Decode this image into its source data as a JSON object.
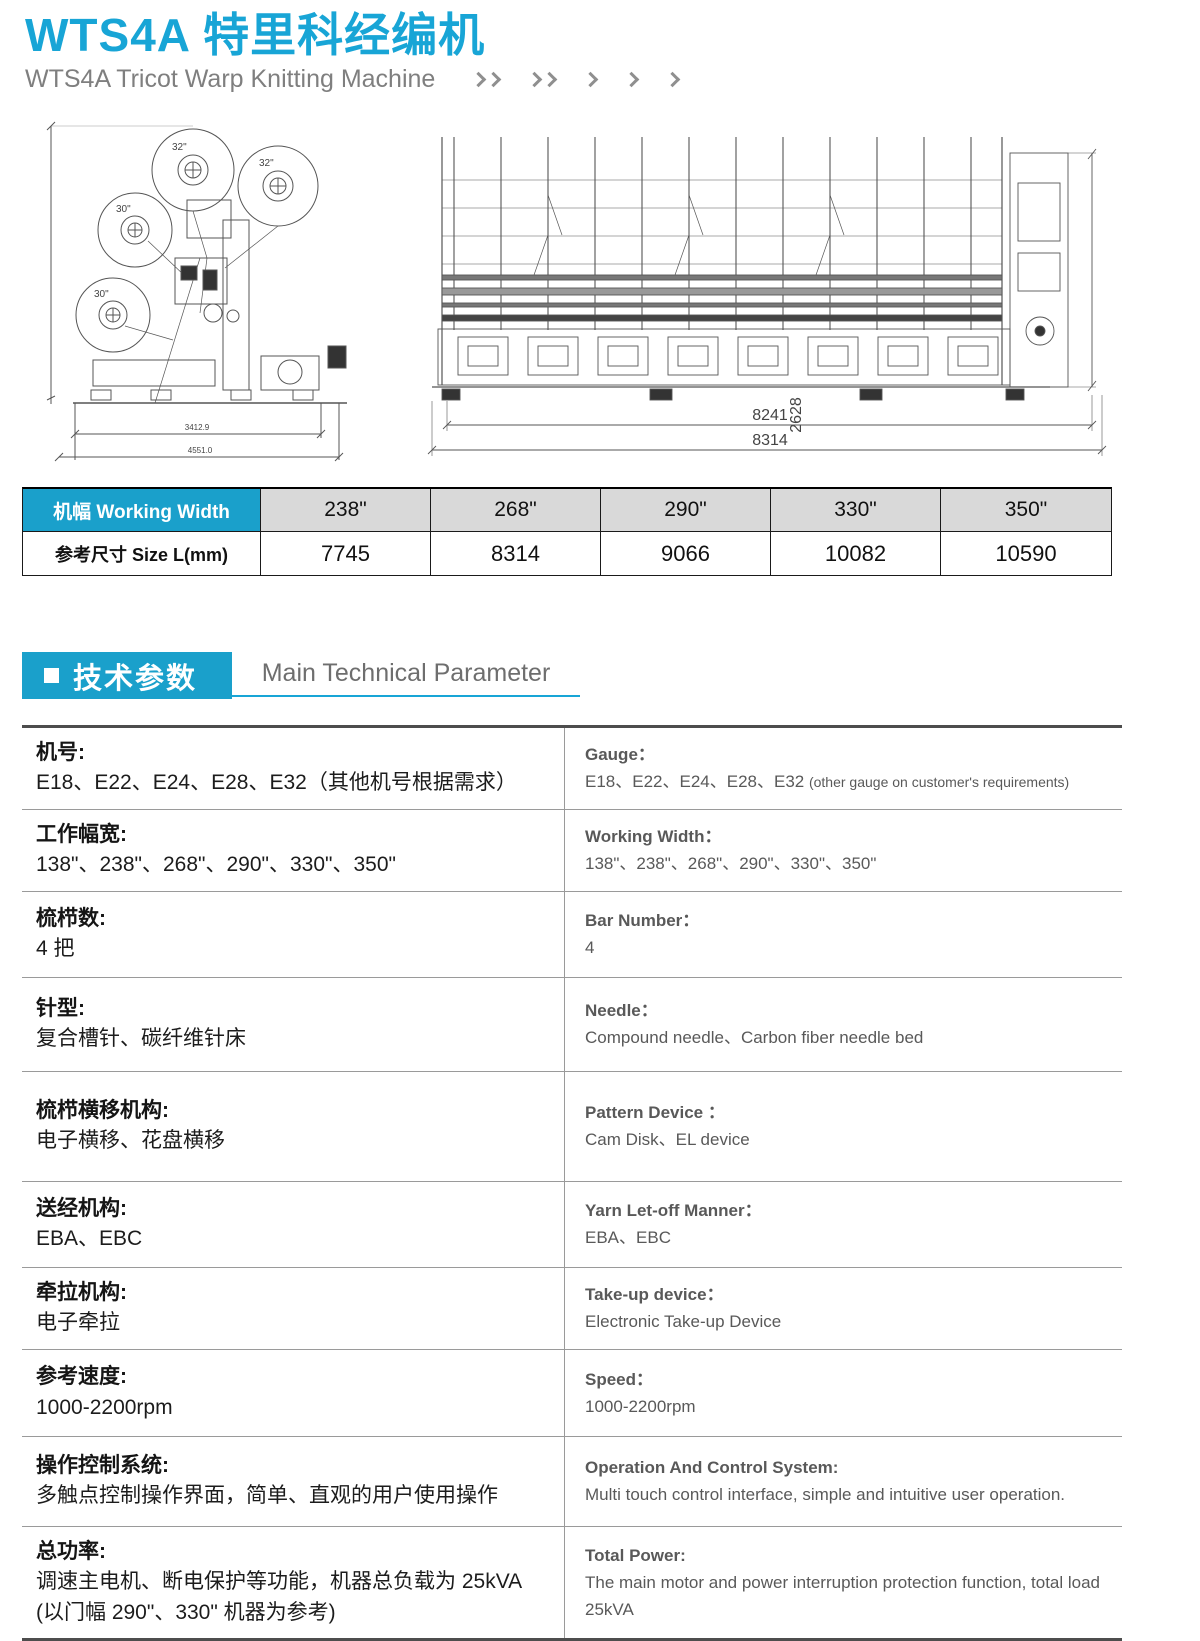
{
  "colors": {
    "accent": "#18a5d6",
    "accent-box": "#1aa0cb"
  },
  "header": {
    "title": "WTS4A 特里科经编机",
    "subtitle": "WTS4A Tricot Warp Knitting Machine"
  },
  "diagrams": {
    "side_view": {
      "beam_labels": [
        "32\"",
        "32\"",
        "30\"",
        "30\""
      ],
      "dim_height": "2568.8",
      "dim_width_inner": "3412.9",
      "dim_width_outer": "4551.0"
    },
    "front_view": {
      "dim_height": "2628",
      "dim_width_inner": "8241",
      "dim_width_outer": "8314"
    }
  },
  "size_table": {
    "header_label": "机幅 Working Width",
    "row_label": "参考尺寸 Size L(mm)",
    "widths": [
      "238\"",
      "268\"",
      "290\"",
      "330\"",
      "350\""
    ],
    "sizes": [
      "7745",
      "8314",
      "9066",
      "10082",
      "10590"
    ]
  },
  "section": {
    "title_cn": "技术参数",
    "title_en": "Main Technical Parameter"
  },
  "spec_rows": [
    {
      "cn_label": "机号:",
      "cn_value": "E18、E22、E24、E28、E32（其他机号根据需求）",
      "en_label": "Gauge：",
      "en_value": "E18、E22、E24、E28、E32 ",
      "en_note": "(other gauge on customer's requirements)"
    },
    {
      "cn_label": "工作幅宽:",
      "cn_value": "138\"、238\"、268\"、290\"、330\"、350\"",
      "en_label": "Working Width：",
      "en_value": "138\"、238\"、268\"、290\"、330\"、350\""
    },
    {
      "cn_label": "梳栉数:",
      "cn_value": "4 把",
      "en_label": "Bar Number：",
      "en_value": "4"
    },
    {
      "cn_label": "针型:",
      "cn_value": "复合槽针、碳纤维针床",
      "en_label": "Needle：",
      "en_value": "Compound needle、Carbon fiber needle bed"
    },
    {
      "cn_label": "梳栉横移机构:",
      "cn_value": "电子横移、花盘横移",
      "en_label": "Pattern Device ：",
      "en_value": "Cam Disk、EL device"
    },
    {
      "cn_label": "送经机构:",
      "cn_value": "EBA、EBC",
      "en_label": "Yarn Let-off Manner：",
      "en_value": "EBA、EBC"
    },
    {
      "cn_label": "牵拉机构:",
      "cn_value": "电子牵拉",
      "en_label": "Take-up device：",
      "en_value": "Electronic Take-up Device"
    },
    {
      "cn_label": "参考速度:",
      "cn_value": "1000-2200rpm",
      "en_label": "Speed：",
      "en_value": "1000-2200rpm"
    },
    {
      "cn_label": "操作控制系统:",
      "cn_value": "多触点控制操作界面，简单、直观的用户使用操作",
      "en_label": "Operation And Control System:",
      "en_value": "Multi touch control interface, simple and intuitive user operation."
    },
    {
      "cn_label": "总功率:",
      "cn_value": "调速主电机、断电保护等功能，机器总负载为 25kVA",
      "cn_value2": "(以门幅 290\"、330\" 机器为参考)",
      "en_label": "Total Power:",
      "en_value": "The main motor and power interruption protection function,  total load 25kVA"
    }
  ]
}
